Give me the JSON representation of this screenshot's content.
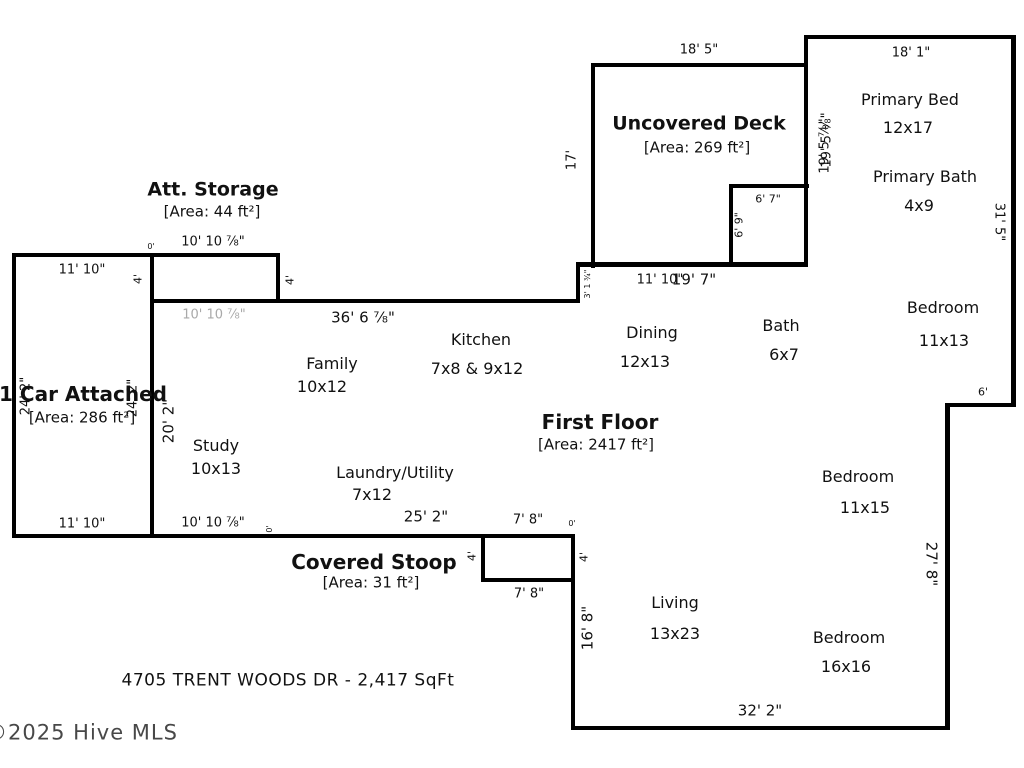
{
  "sections": {
    "deck": {
      "title": "Uncovered Deck",
      "area": "[Area: 269 ft²]"
    },
    "storage": {
      "title": "Att. Storage",
      "area": "[Area: 44 ft²]"
    },
    "garage": {
      "title": "1 Car Attached",
      "area": "[Area: 286 ft²]"
    },
    "stoop": {
      "title": "Covered Stoop",
      "area": "[Area: 31 ft²]"
    },
    "floor": {
      "title": "First Floor",
      "area": "[Area: 2417 ft²]"
    }
  },
  "rooms": {
    "primary_bed": {
      "label": "Primary Bed",
      "size": "12x17"
    },
    "primary_bath": {
      "label": "Primary Bath",
      "size": "4x9"
    },
    "bedroom1": {
      "label": "Bedroom",
      "size": "11x13"
    },
    "bedroom2": {
      "label": "Bedroom",
      "size": "11x15"
    },
    "bedroom3": {
      "label": "Bedroom",
      "size": "16x16"
    },
    "living": {
      "label": "Living",
      "size": "13x23"
    },
    "dining": {
      "label": "Dining",
      "size": "12x13"
    },
    "bath": {
      "label": "Bath",
      "size": "6x7"
    },
    "kitchen": {
      "label": "Kitchen",
      "size": "7x8 & 9x12"
    },
    "family": {
      "label": "Family",
      "size": "10x12"
    },
    "study": {
      "label": "Study",
      "size": "10x13"
    },
    "laundry": {
      "label": "Laundry/Utility",
      "size": "7x12"
    }
  },
  "dims": {
    "deck_top": "18' 5\"",
    "suite_top": "18' 1\"",
    "deck_left": "17'",
    "suite_left_a": "19' 5 ⅞\"",
    "suite_left_b": "19' 5 ⅛\"",
    "deck_inner_w": "6' 7\"",
    "deck_inner_h": "6' 9\"",
    "right_upper": "31' 5\"",
    "zero_storage": "0'",
    "storage_top": "10' 10 ⅞\"",
    "storage_h_left": "4'",
    "storage_h_right": "4'",
    "garage_top": "11' 10\"",
    "storage_bottom": "10' 10 ⅞\"",
    "main_top": "36' 6 ⅞\"",
    "step_upper": "3' 1 ¾\"",
    "under_deck_a": "11' 10\"",
    "under_deck_b": "19' 7\"",
    "garage_left": "24' 2\"",
    "garage_right": "24' 2\"",
    "study_left": "20' 2\"",
    "right_step": "6'",
    "right_lower": "27' 8\"",
    "garage_bottom": "11' 10\"",
    "study_bottom": "10' 10 ⅞\"",
    "zero_bottom": "0'",
    "stoop_span": "25' 2\"",
    "stoop_top": "7' 8\"",
    "zero_stoop": "0'",
    "stoop_h_left": "4'",
    "stoop_h_right": "4'",
    "stoop_bottom": "7' 8\"",
    "living_left": "16' 8\"",
    "bottom": "32' 2\""
  },
  "footer": {
    "address": "4705 TRENT WOODS DR - 2,417 SqFt",
    "watermark": "©2025 Hive MLS"
  },
  "colors": {
    "wall": "#000000",
    "dim_gray": "#a9a9a9",
    "watermark": "#484848"
  }
}
